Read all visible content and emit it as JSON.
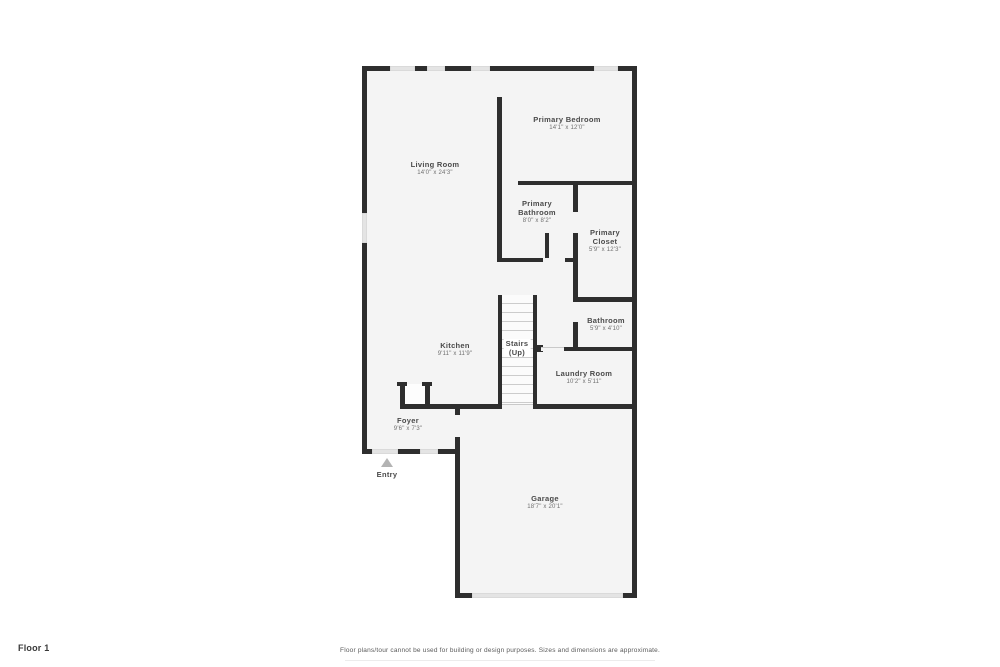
{
  "floor_plan": {
    "rooms": {
      "living_room": {
        "name": "Living Room",
        "dims": "14'0\" x 24'3\""
      },
      "primary_bedroom": {
        "name": "Primary Bedroom",
        "dims": "14'1\" x 12'0\""
      },
      "primary_bathroom": {
        "name_line1": "Primary",
        "name_line2": "Bathroom",
        "dims": "8'0\" x 8'2\""
      },
      "primary_closet": {
        "name_line1": "Primary",
        "name_line2": "Closet",
        "dims": "5'9\" x 12'3\""
      },
      "bathroom": {
        "name": "Bathroom",
        "dims": "5'9\" x 4'10\""
      },
      "laundry_room": {
        "name": "Laundry Room",
        "dims": "10'2\" x 5'11\""
      },
      "kitchen": {
        "name": "Kitchen",
        "dims": "9'11\" x 11'9\""
      },
      "stairs": {
        "name": "Stairs",
        "sub": "(Up)"
      },
      "foyer": {
        "name": "Foyer",
        "dims": "9'6\" x 7'3\""
      },
      "garage": {
        "name": "Garage",
        "dims": "18'7\" x 20'1\""
      }
    },
    "entry": {
      "label": "Entry"
    },
    "colors": {
      "wall": "#2e2e2e",
      "room_fill": "#f4f4f4",
      "window_marker": "#e4e4e4",
      "entry_arrow": "#b3b3b3",
      "background": "#ffffff"
    }
  },
  "footer": {
    "floor_label": "Floor 1",
    "disclaimer": "Floor plans/tour cannot be used for building or design purposes. Sizes and dimensions are approximate."
  }
}
